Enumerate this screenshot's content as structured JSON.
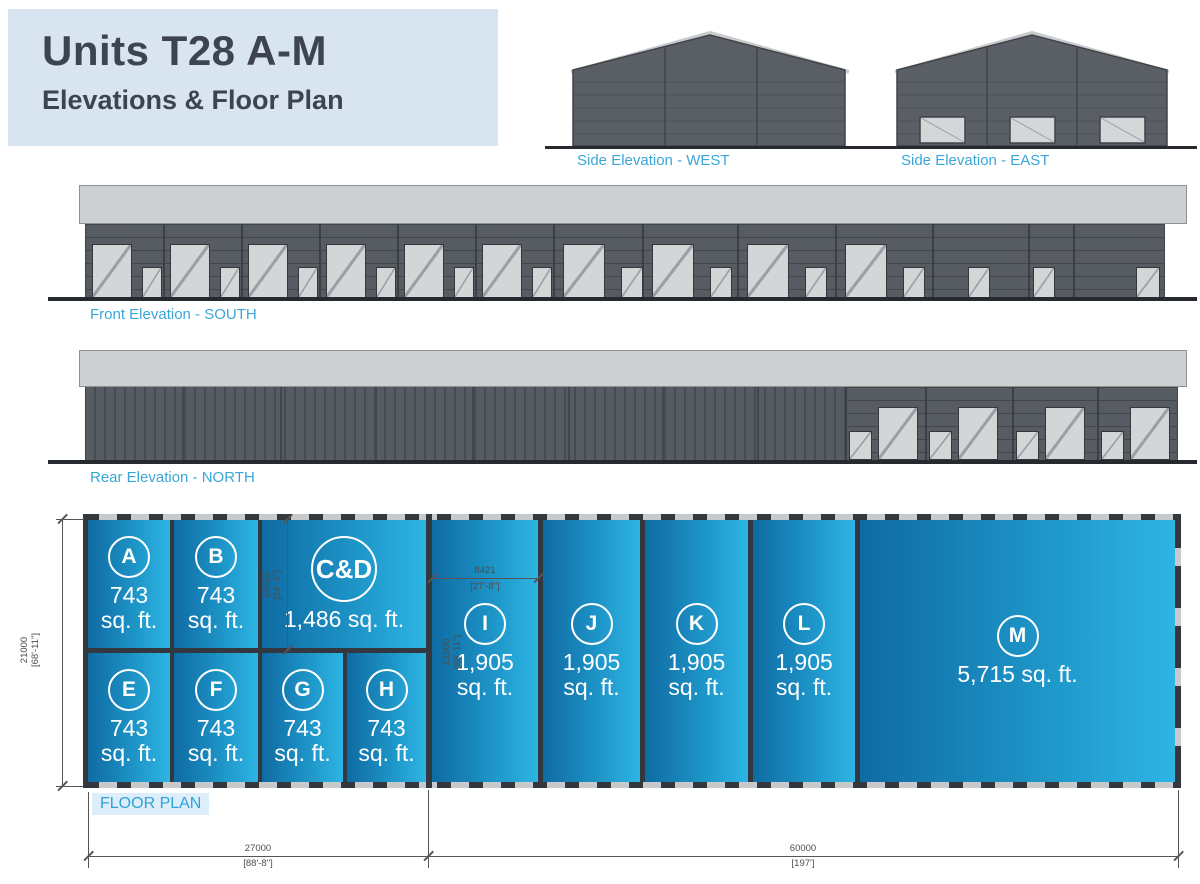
{
  "title": {
    "line1": "Units T28 A-M",
    "line2": "Elevations & Floor Plan"
  },
  "elevations": {
    "west_label": "Side Elevation - WEST",
    "east_label": "Side Elevation - EAST",
    "south_label": "Front Elevation - SOUTH",
    "north_label": "Rear Elevation - NORTH"
  },
  "floor_plan": {
    "label": "FLOOR PLAN",
    "units": [
      {
        "label": "A",
        "area_line1": "743",
        "area_line2": "sq. ft."
      },
      {
        "label": "B",
        "area_line1": "743",
        "area_line2": "sq. ft."
      },
      {
        "label": "C&D",
        "area_line1": "1,486 sq. ft.",
        "area_line2": ""
      },
      {
        "label": "E",
        "area_line1": "743",
        "area_line2": "sq. ft."
      },
      {
        "label": "F",
        "area_line1": "743",
        "area_line2": "sq. ft."
      },
      {
        "label": "G",
        "area_line1": "743",
        "area_line2": "sq. ft."
      },
      {
        "label": "H",
        "area_line1": "743",
        "area_line2": "sq. ft."
      },
      {
        "label": "I",
        "area_line1": "1,905",
        "area_line2": "sq. ft."
      },
      {
        "label": "J",
        "area_line1": "1,905",
        "area_line2": "sq. ft."
      },
      {
        "label": "K",
        "area_line1": "1,905",
        "area_line2": "sq. ft."
      },
      {
        "label": "L",
        "area_line1": "1,905",
        "area_line2": "sq. ft."
      },
      {
        "label": "M",
        "area_line1": "5,715 sq. ft.",
        "area_line2": ""
      }
    ],
    "dimensions": {
      "overall_depth_mm": "21000",
      "overall_depth_ft": "[68'-11\"]",
      "cd_depth_mm": "10425",
      "cd_depth_ft": "[34'-3\"]",
      "unit_i_width_mm": "8421",
      "unit_i_width_ft": "[27'-8\"]",
      "unit_i_depth_mm": "21000",
      "unit_i_depth_ft": "[68'-11\"]",
      "left_block_mm": "27000",
      "left_block_ft": "[88'-8\"]",
      "right_block_mm": "60000",
      "right_block_ft": "[197']"
    }
  },
  "colors": {
    "accent_blue": "#3aa6d8",
    "title_panel_bg": "#d8e4f0",
    "title_text": "#3d4450",
    "unit_gradient_start": "#0f6ba3",
    "unit_gradient_end": "#2db5e4",
    "plan_wall_dark": "#33383e",
    "cladding_gray": "#575c62",
    "fascia_gray": "#cdcfd1",
    "door_gray": "#d3d5d7"
  }
}
